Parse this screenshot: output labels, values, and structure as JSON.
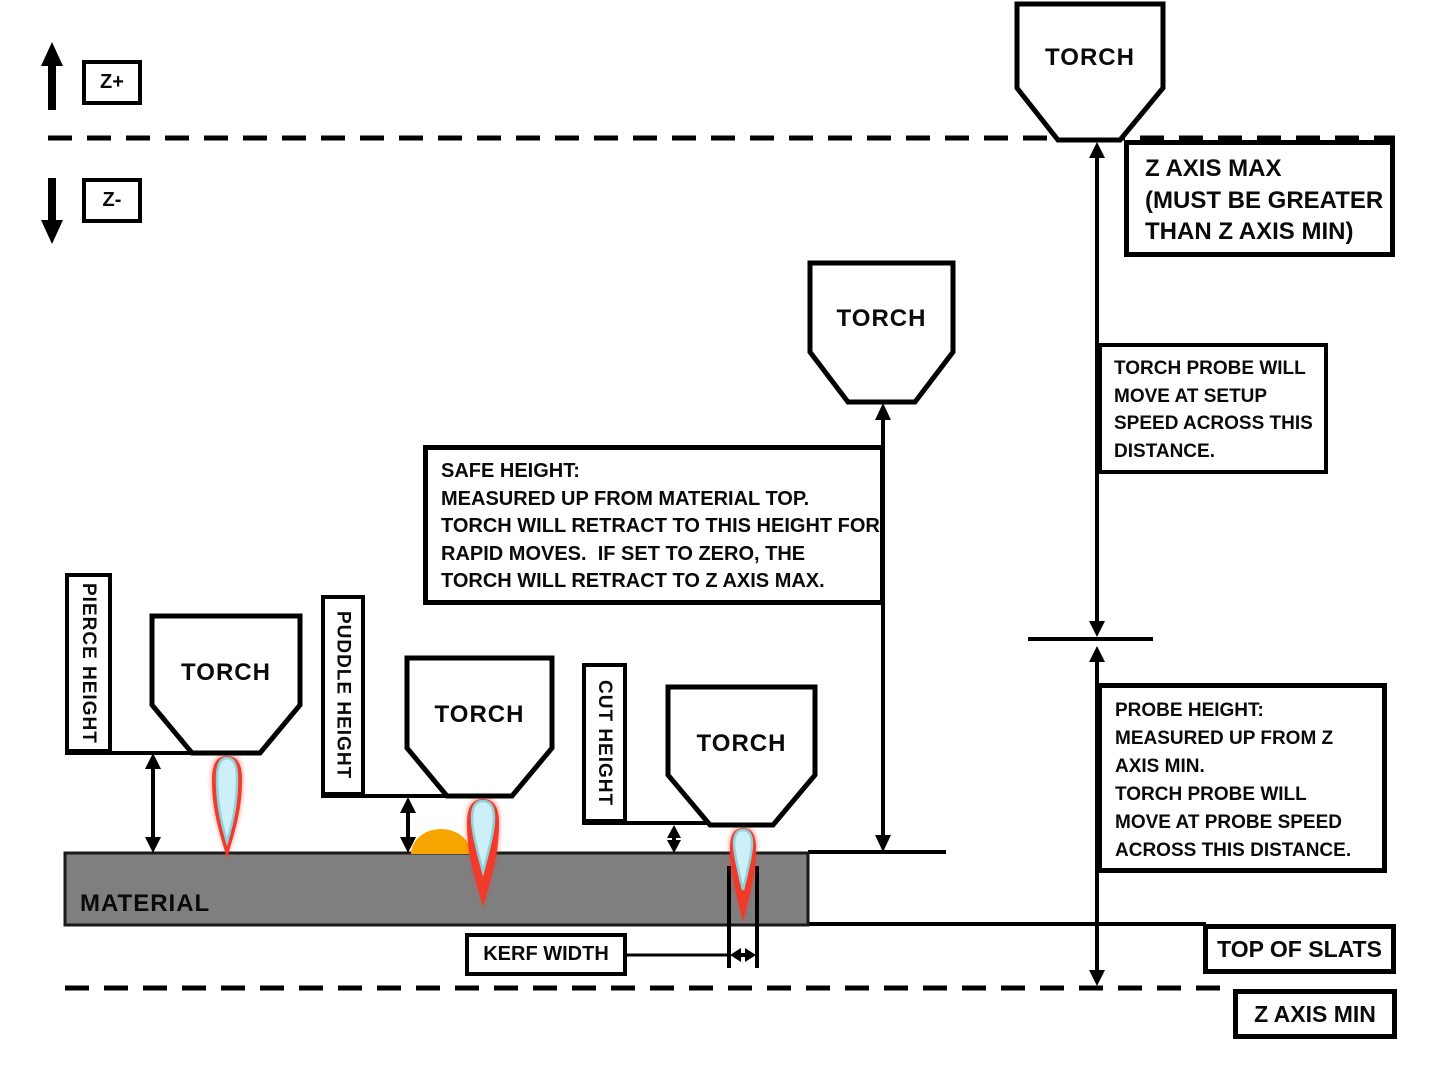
{
  "axis": {
    "z_plus": "Z+",
    "z_minus": "Z-"
  },
  "torch_label": "TORCH",
  "material_label": "MATERIAL",
  "labels": {
    "pierce_height": "PIERCE HEIGHT",
    "puddle_height": "PUDDLE HEIGHT",
    "cut_height": "CUT HEIGHT",
    "kerf_width": "KERF WIDTH",
    "top_of_slats": "TOP OF SLATS",
    "z_axis_min": "Z AXIS MIN"
  },
  "boxes": {
    "z_axis_max": {
      "lines": [
        "Z AXIS MAX",
        "(MUST BE GREATER",
        "THAN Z AXIS MIN)"
      ]
    },
    "torch_probe": {
      "lines": [
        "TORCH PROBE WILL",
        "MOVE AT SETUP",
        "SPEED ACROSS THIS",
        "DISTANCE."
      ]
    },
    "safe_height": {
      "lines": [
        "SAFE HEIGHT:",
        "MEASURED UP FROM MATERIAL TOP.",
        "TORCH WILL RETRACT TO THIS HEIGHT FOR",
        "RAPID MOVES.  IF SET TO ZERO, THE",
        "TORCH WILL RETRACT TO Z AXIS MAX."
      ]
    },
    "probe_height": {
      "lines": [
        "PROBE HEIGHT:",
        "MEASURED UP FROM Z",
        "AXIS MIN.",
        "TORCH PROBE WILL",
        "MOVE AT PROBE SPEED",
        "ACROSS THIS DISTANCE."
      ]
    }
  },
  "colors": {
    "material_gray": "#7F7F7F",
    "outline_black": "#000000",
    "flame_red": "#F23A2B",
    "flame_inner_blue": "#CDEFF8",
    "flame_teal_edge": "#8FD2DA",
    "puddle_orange": "#F7A600"
  }
}
